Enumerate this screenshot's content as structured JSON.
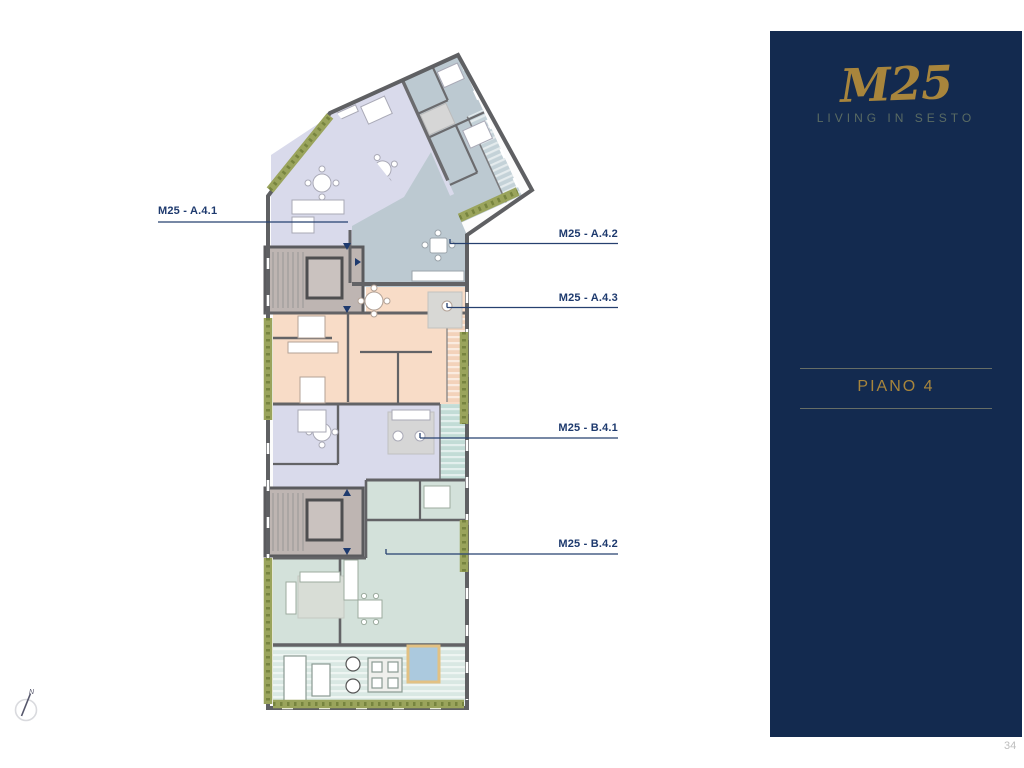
{
  "page": {
    "number": "34"
  },
  "sidebar": {
    "logo": "M25",
    "tagline": "LIVING IN SESTO",
    "floor_label": "PIANO 4"
  },
  "plan": {
    "compass_label": "N",
    "labels": [
      {
        "text": "M25 - A.4.1"
      },
      {
        "text": "M25 - A.4.2"
      },
      {
        "text": "M25 - A.4.3"
      },
      {
        "text": "M25 - B.4.1"
      },
      {
        "text": "M25 - B.4.2"
      }
    ],
    "colors": {
      "wall": "#5f6063",
      "apartment_a41": "#d9daeb",
      "apartment_a42": "#bcc9d1",
      "apartment_a43": "#f8dcc7",
      "apartment_b41": "#d9daeb",
      "apartment_b42": "#d3e1da",
      "stair_core": "#beb5b2",
      "terrace": "#d9e8e3",
      "hedge": "#9aa45c",
      "pool_water": "#abc9de",
      "pool_deck": "#e2c183",
      "label_line": "#26406f",
      "label_text": "#1e3a6e",
      "sidebar_bg": "#132a4f",
      "gold": "#a8853c",
      "tagline_color": "#5a6b63"
    }
  }
}
